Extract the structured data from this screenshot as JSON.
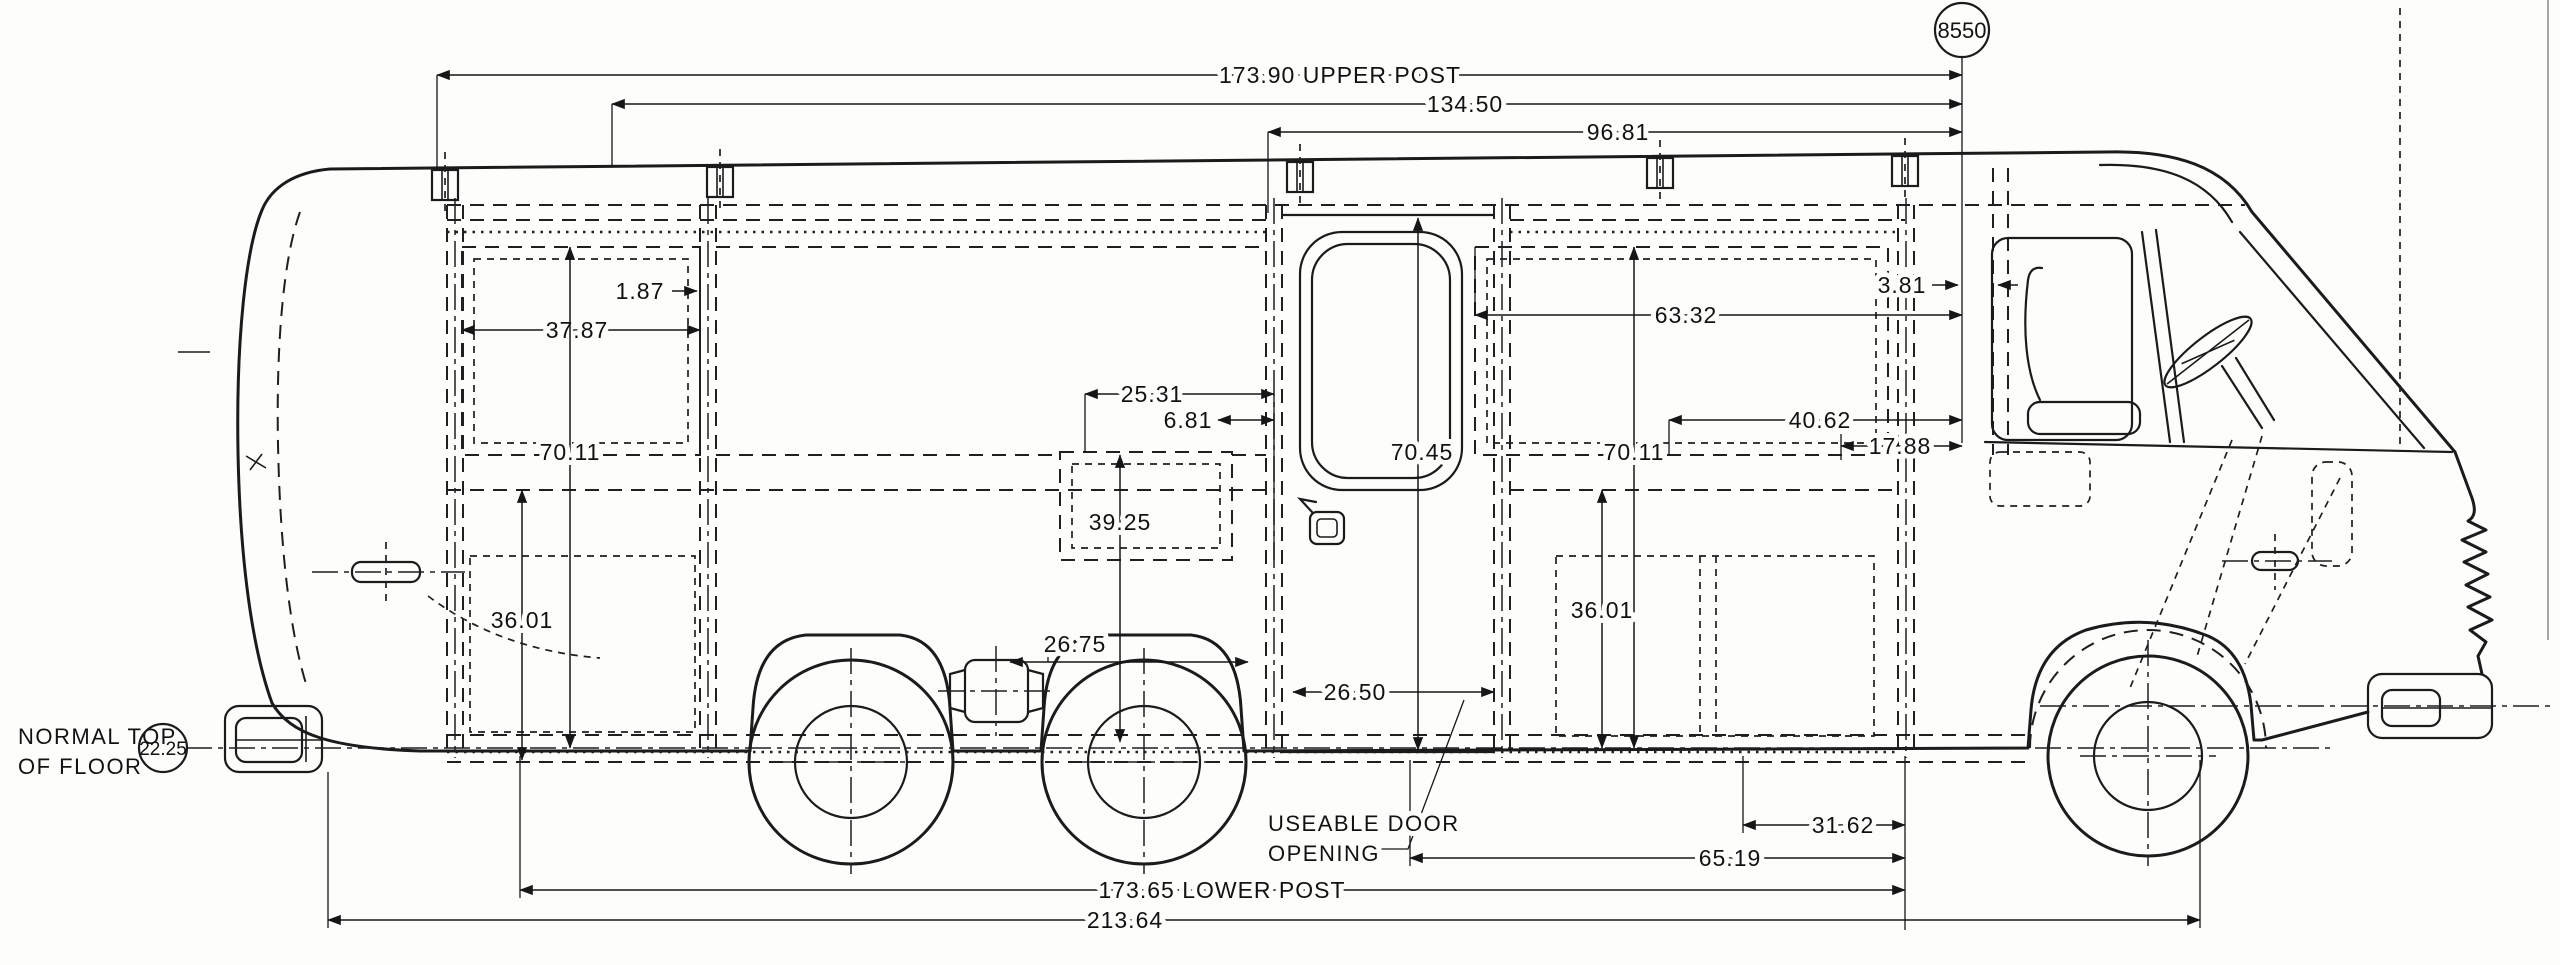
{
  "balloons": {
    "upper": "8550",
    "floor_height": "22.25"
  },
  "notes": {
    "floor_line1": "NORMAL TOP",
    "floor_line2": "OF FLOOR",
    "door_line1": "USEABLE DOOR",
    "door_line2": "OPENING"
  },
  "dimensions": {
    "upper_post": "173.90 UPPER POST",
    "mid_upper": "134.50",
    "front_upper": "96.81",
    "rear_window_width": "37.87",
    "post_width": "1.87",
    "left_interior_height": "70.11",
    "left_sill_height": "36.01",
    "galley_width": "25.31",
    "galley_gap": "6.81",
    "galley_sill_height": "39.25",
    "axle_area": "26.75",
    "door_opening_width": "26.50",
    "door_height": "70.45",
    "front_window_width": "63.32",
    "cab_dim": "40.62",
    "cab_small_dim": "17.88",
    "pillar_gap": "3.81",
    "right_interior_height": "70.11",
    "right_sill_height": "36.01",
    "front_lower_small": "31.62",
    "front_lower_mid": "65.19",
    "lower_post": "173.65 LOWER POST",
    "overall_lower": "213.64"
  }
}
